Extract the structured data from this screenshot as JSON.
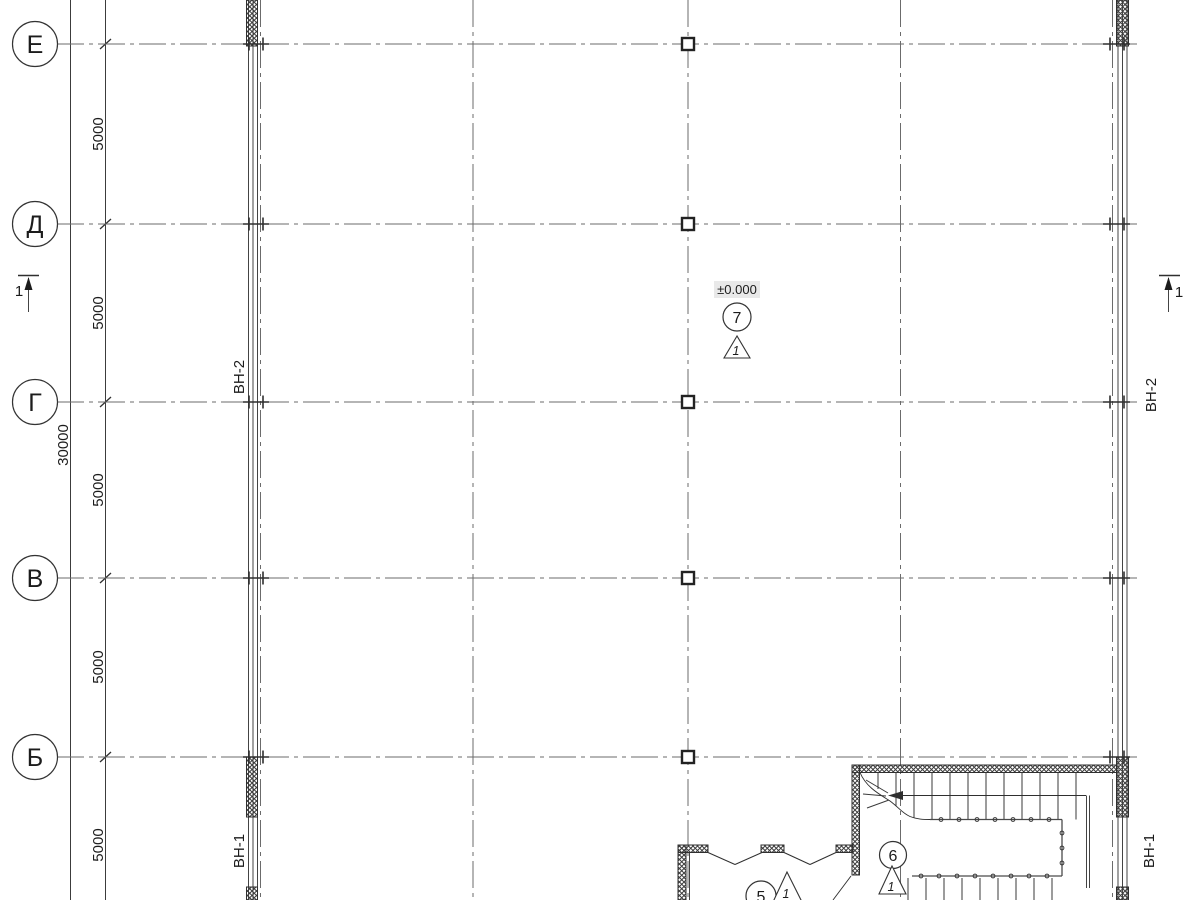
{
  "axes": {
    "rows": [
      {
        "label": "Е"
      },
      {
        "label": "Д"
      },
      {
        "label": "Г"
      },
      {
        "label": "В"
      },
      {
        "label": "Б"
      }
    ]
  },
  "dims": {
    "segments": [
      "5000",
      "5000",
      "5000",
      "5000",
      "5000"
    ],
    "overall": "30000"
  },
  "wall_tags": {
    "left_upper": "ВН-2",
    "right_upper": "ВН-2",
    "left_lower": "ВН-1",
    "right_lower": "ВН-1"
  },
  "level": {
    "value": "±0.000"
  },
  "rooms": [
    {
      "number": "7",
      "detail": "1"
    },
    {
      "number": "6",
      "detail": "1"
    },
    {
      "number": "5",
      "detail": "1"
    }
  ],
  "sections": {
    "left_label": "1",
    "right_label": "1"
  },
  "colors": {
    "line": "#2f2f2f",
    "grid": "#6b6b6b",
    "level_bg": "#e9e9e9"
  }
}
